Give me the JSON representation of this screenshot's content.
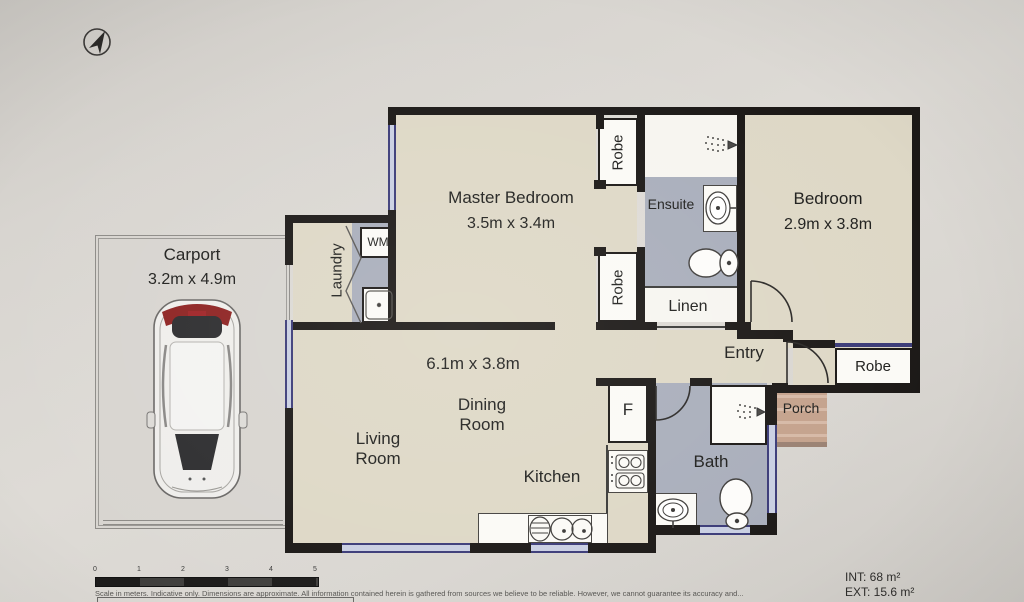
{
  "rooms": {
    "carport": {
      "name": "Carport",
      "dims": "3.2m x 4.9m"
    },
    "master_bedroom": {
      "name": "Master Bedroom",
      "dims": "3.5m x 3.4m"
    },
    "bedroom": {
      "name": "Bedroom",
      "dims": "2.9m x 3.8m"
    },
    "living_area": {
      "dims": "6.1m x 3.8m",
      "dining": "Dining Room",
      "living": "Living Room",
      "kitchen": "Kitchen"
    },
    "laundry": {
      "name": "Laundry",
      "washer": "WM"
    },
    "ensuite": {
      "name": "Ensuite"
    },
    "linen": {
      "name": "Linen"
    },
    "entry": {
      "name": "Entry"
    },
    "porch": {
      "name": "Porch"
    },
    "bath": {
      "name": "Bath"
    },
    "fridge": {
      "label": "F"
    },
    "robes": {
      "master_top": "Robe",
      "master_bottom": "Robe",
      "bedroom": "Robe"
    }
  },
  "areas": {
    "internal": "INT: 68 m²",
    "external": "EXT: 15.6 m²"
  },
  "scale_bar": {
    "ticks": [
      "0",
      "1",
      "2",
      "3",
      "4",
      "5"
    ],
    "caption": "Scale in meters. Indicative only. Dimensions are approximate. All information contained herein is gathered from sources we believe to be reliable. However, we cannot guarantee its accuracy and..."
  },
  "colors": {
    "wall": "#1b1816",
    "floor": "#ded8c6",
    "wet_floor": "#a9aebb",
    "window": "#3b3b78",
    "porch": "#c4a28c"
  }
}
